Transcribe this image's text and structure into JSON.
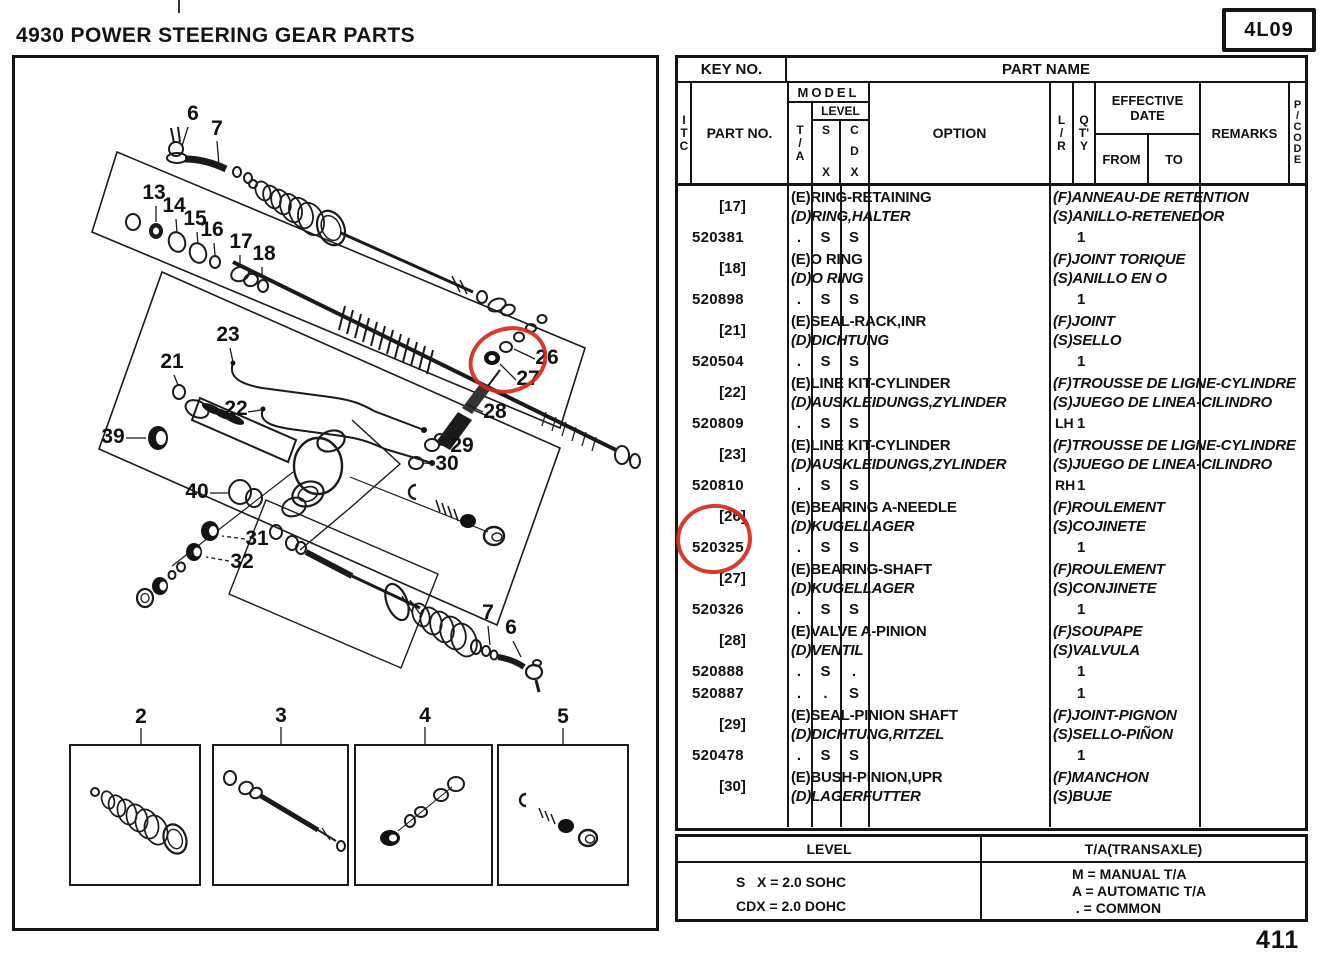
{
  "page": {
    "title": "4930 POWER STEERING GEAR PARTS",
    "sheet_code": "4L09",
    "page_number": "411"
  },
  "diagram": {
    "annotation_color": "#d42a1e",
    "callouts": [
      {
        "label": "6",
        "x": 193,
        "y": 120,
        "leader": [
          188,
          127,
          182,
          146
        ]
      },
      {
        "label": "7",
        "x": 217,
        "y": 135,
        "leader": [
          217,
          141,
          219,
          165
        ]
      },
      {
        "label": "13",
        "x": 154,
        "y": 199,
        "leader": [
          156,
          206,
          156,
          222
        ]
      },
      {
        "label": "14",
        "x": 174,
        "y": 212,
        "leader": [
          176,
          219,
          177,
          233
        ]
      },
      {
        "label": "15",
        "x": 195,
        "y": 225,
        "leader": [
          197,
          232,
          198,
          244
        ]
      },
      {
        "label": "16",
        "x": 212,
        "y": 236,
        "leader": [
          214,
          243,
          215,
          255
        ]
      },
      {
        "label": "17",
        "x": 241,
        "y": 248,
        "leader": [
          240,
          255,
          240,
          266
        ]
      },
      {
        "label": "18",
        "x": 264,
        "y": 260,
        "leader": [
          262,
          267,
          262,
          278
        ]
      },
      {
        "label": "23",
        "x": 228,
        "y": 341,
        "leader": [
          230,
          348,
          233,
          362
        ]
      },
      {
        "label": "21",
        "x": 172,
        "y": 368,
        "leader": [
          174,
          375,
          178,
          385
        ]
      },
      {
        "label": "22",
        "x": 236,
        "y": 415,
        "leader": [
          248,
          412,
          261,
          410
        ]
      },
      {
        "label": "39",
        "x": 113,
        "y": 443,
        "leader": [
          126,
          438,
          146,
          438
        ]
      },
      {
        "label": "40",
        "x": 197,
        "y": 498,
        "leader": [
          210,
          493,
          228,
          493
        ]
      },
      {
        "label": "26",
        "x": 547,
        "y": 364,
        "leader": [
          535,
          359,
          514,
          349
        ]
      },
      {
        "label": "27",
        "x": 528,
        "y": 385,
        "leader": [
          516,
          380,
          500,
          364
        ]
      },
      {
        "label": "28",
        "x": 495,
        "y": 418,
        "leader": [
          483,
          412,
          466,
          404
        ]
      },
      {
        "label": "29",
        "x": 462,
        "y": 452,
        "leader": [
          449,
          446,
          440,
          445
        ]
      },
      {
        "label": "30",
        "x": 447,
        "y": 470,
        "leader": [
          435,
          464,
          424,
          463
        ]
      },
      {
        "label": "31",
        "x": 257,
        "y": 545,
        "leader": [
          245,
          539,
          222,
          536
        ],
        "dashed": true
      },
      {
        "label": "32",
        "x": 242,
        "y": 568,
        "leader": [
          229,
          561,
          206,
          557
        ],
        "dashed": true
      },
      {
        "label": "7",
        "x": 488,
        "y": 619,
        "leader": [
          488,
          626,
          490,
          645
        ]
      },
      {
        "label": "6",
        "x": 511,
        "y": 634,
        "leader": [
          513,
          641,
          521,
          657
        ]
      },
      {
        "label": "2",
        "x": 141,
        "y": 723,
        "leader": [
          141,
          728,
          141,
          745
        ]
      },
      {
        "label": "3",
        "x": 281,
        "y": 722,
        "leader": [
          281,
          727,
          281,
          745
        ]
      },
      {
        "label": "4",
        "x": 425,
        "y": 722,
        "leader": [
          425,
          727,
          425,
          745
        ]
      },
      {
        "label": "5",
        "x": 563,
        "y": 723,
        "leader": [
          563,
          728,
          563,
          745
        ]
      }
    ]
  },
  "table": {
    "header": {
      "key_no": "KEY NO.",
      "part_name": "PART NAME",
      "itc": "I|T|C",
      "part_no": "PART NO.",
      "model": "MODEL",
      "ta": "T|/|A",
      "level": "LEVEL",
      "sx": "S|X",
      "cdx": "C|D|X",
      "option": "OPTION",
      "lr": "L|/|R",
      "qty": "Q|T'|Y",
      "effective_date": "EFFECTIVE DATE",
      "from": "FROM",
      "to": "TO",
      "remarks": "REMARKS",
      "pcode": "P|/|C|O|D|E"
    },
    "entries": [
      {
        "key": "[17]",
        "en": "(E)RING-RETAINING",
        "de": "(D)RING,HALTER",
        "fr": "(F)ANNEAU-DE RETENTION",
        "es": "(S)ANILLO-RETENEDOR",
        "parts": [
          {
            "no": "520381",
            "ta": ".",
            "sx": "S",
            "cdx": "S",
            "lr": "",
            "qty": "1"
          }
        ]
      },
      {
        "key": "[18]",
        "en": "(E)O RING",
        "de": "(D)O RING",
        "fr": "(F)JOINT TORIQUE",
        "es": "(S)ANILLO EN O",
        "parts": [
          {
            "no": "520898",
            "ta": ".",
            "sx": "S",
            "cdx": "S",
            "lr": "",
            "qty": "1"
          }
        ]
      },
      {
        "key": "[21]",
        "en": "(E)SEAL-RACK,INR",
        "de": "(D)DICHTUNG",
        "fr": "(F)JOINT",
        "es": "(S)SELLO",
        "parts": [
          {
            "no": "520504",
            "ta": ".",
            "sx": "S",
            "cdx": "S",
            "lr": "",
            "qty": "1"
          }
        ]
      },
      {
        "key": "[22]",
        "en": "(E)LINE KIT-CYLINDER",
        "de": "(D)AUSKLEIDUNGS,ZYLINDER",
        "fr": "(F)TROUSSE DE LIGNE-CYLINDRE",
        "es": "(S)JUEGO DE LINEA-CILINDRO",
        "parts": [
          {
            "no": "520809",
            "ta": ".",
            "sx": "S",
            "cdx": "S",
            "lr": "LH",
            "qty": "1"
          }
        ]
      },
      {
        "key": "[23]",
        "en": "(E)LINE KIT-CYLINDER",
        "de": "(D)AUSKLEIDUNGS,ZYLINDER",
        "fr": "(F)TROUSSE DE LIGNE-CYLINDRE",
        "es": "(S)JUEGO DE LINEA-CILINDRO",
        "parts": [
          {
            "no": "520810",
            "ta": ".",
            "sx": "S",
            "cdx": "S",
            "lr": "RH",
            "qty": "1"
          }
        ]
      },
      {
        "key": "[26]",
        "circled": true,
        "en": "(E)BEARING A-NEEDLE",
        "de": "(D)KUGELLAGER",
        "fr": "(F)ROULEMENT",
        "es": "(S)COJINETE",
        "parts": [
          {
            "no": "520325",
            "ta": ".",
            "sx": "S",
            "cdx": "S",
            "lr": "",
            "qty": "1"
          }
        ]
      },
      {
        "key": "[27]",
        "en": "(E)BEARING-SHAFT",
        "de": "(D)KUGELLAGER",
        "fr": "(F)ROULEMENT",
        "es": "(S)CONJINETE",
        "parts": [
          {
            "no": "520326",
            "ta": ".",
            "sx": "S",
            "cdx": "S",
            "lr": "",
            "qty": "1"
          }
        ]
      },
      {
        "key": "[28]",
        "en": "(E)VALVE A-PINION",
        "de": "(D)VENTIL",
        "fr": "(F)SOUPAPE",
        "es": "(S)VALVULA",
        "parts": [
          {
            "no": "520888",
            "ta": ".",
            "sx": "S",
            "cdx": ".",
            "lr": "",
            "qty": "1"
          },
          {
            "no": "520887",
            "ta": ".",
            "sx": ".",
            "cdx": "S",
            "lr": "",
            "qty": "1"
          }
        ]
      },
      {
        "key": "[29]",
        "en": "(E)SEAL-PINION SHAFT",
        "de": "(D)DICHTUNG,RITZEL",
        "fr": "(F)JOINT-PIGNON",
        "es": "(S)SELLO-PIÑON",
        "parts": [
          {
            "no": "520478",
            "ta": ".",
            "sx": "S",
            "cdx": "S",
            "lr": "",
            "qty": "1"
          }
        ]
      },
      {
        "key": "[30]",
        "en": "(E)BUSH-PINION,UPR",
        "de": "(D)LAGERFUTTER",
        "fr": "(F)MANCHON",
        "es": "(S)BUJE",
        "parts": []
      }
    ]
  },
  "legend": {
    "level_title": "LEVEL",
    "level_items": [
      "S   X = 2.0 SOHC",
      "CDX = 2.0 DOHC"
    ],
    "ta_title": "T/A(TRANSAXLE)",
    "ta_items": [
      "M = MANUAL T/A",
      "A = AUTOMATIC T/A",
      " . = COMMON"
    ]
  }
}
